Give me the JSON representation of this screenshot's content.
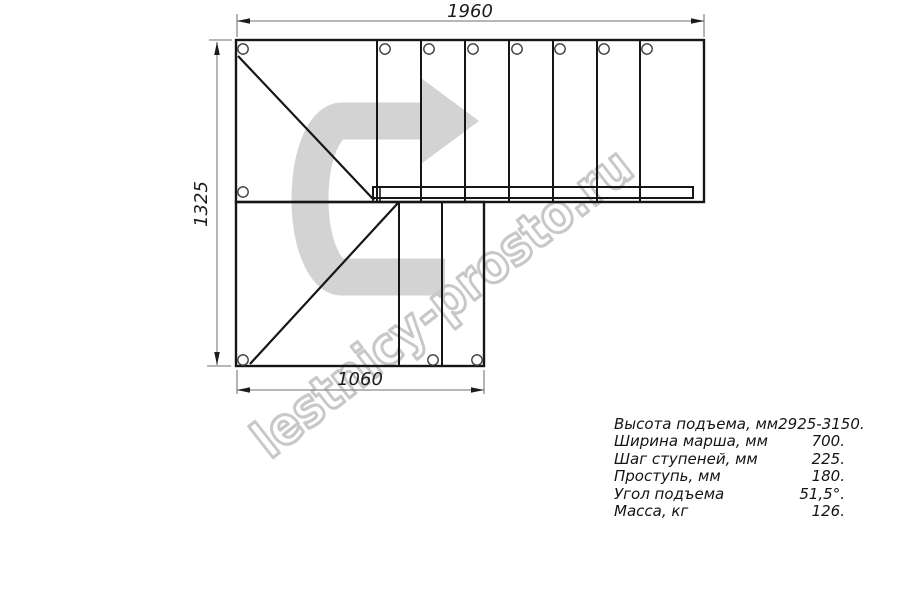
{
  "drawing": {
    "type": "staircase-plan-top-view",
    "dimensions": {
      "top_mm": "1960",
      "left_mm": "1325",
      "bottom_mm": "1060"
    },
    "watermark": "lestnicy-prosto.ru",
    "flights": {
      "top_flight_tread_cells": 7,
      "bottom_flight_tread_cells": 2
    }
  },
  "icons": {
    "direction_arrow": "u-turn-up-then-right-arrow"
  },
  "specs": {
    "rows": [
      {
        "label": "Высота подъема, мм",
        "value": "2925-3150."
      },
      {
        "label": "Ширина марша, мм",
        "value": "700."
      },
      {
        "label": "Шаг ступеней, мм",
        "value": "225."
      },
      {
        "label": "Проступь, мм",
        "value": "180."
      },
      {
        "label": "Угол подъема",
        "value": "51,5°."
      },
      {
        "label": "Масса, кг",
        "value": "126."
      }
    ]
  },
  "colors": {
    "background": "#ffffff",
    "line": "#161616",
    "dimension_line": "#8c8c8c",
    "dimension_text": "#1c1c1c",
    "arrow_fill": "#d3d3d3",
    "watermark_stroke": "#c8c8c8",
    "hole_stroke": "#3f3f3f"
  }
}
